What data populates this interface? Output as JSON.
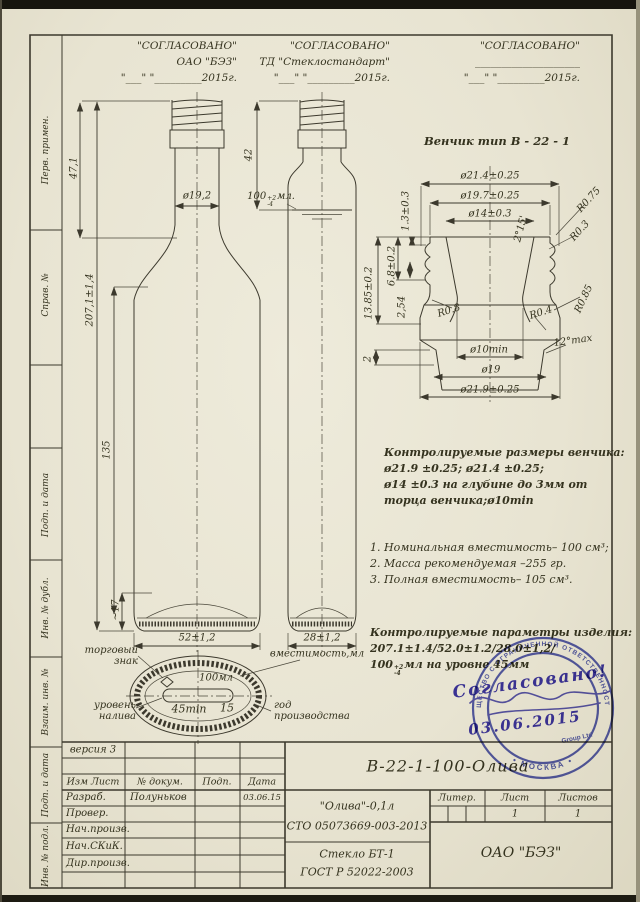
{
  "approvals": [
    {
      "title": "\"СОГЛАСОВАНО\"",
      "org": "ОАО  \"БЭЗ\"",
      "date": "\"___\" \"_________2015г."
    },
    {
      "title": "\"СОГЛАСОВАНО\"",
      "org": "ТД  \"Стеклостандарт\"",
      "date": "\"___\" \"_________2015г."
    },
    {
      "title": "\"СОГЛАСОВАНО\"",
      "org": "____________________",
      "date": "\"___\" \"_________2015г."
    }
  ],
  "margin": [
    "Перв. примен.",
    "Справ. №",
    "Подп. и дата",
    "Инв. № дубл.",
    "Взаим. инв. №",
    "Подп. и дата",
    "Инв. № подл."
  ],
  "bottle": {
    "neck_h": "47,1",
    "neck_d": "ø19,2",
    "total_h": "207,1±1,4",
    "body_h": "135",
    "base_h": "~17",
    "width_front": "52±1,2",
    "side_top": "42",
    "fill_base": "100",
    "fill_sup": "+2",
    "fill_sub": "-4",
    "fill_unit": "мл.",
    "width_side": "28±1,2",
    "capacity_label": "вместимость,мл"
  },
  "finish": {
    "title": "Венчик тип В - 22 - 1",
    "d1": "ø21.4±0.25",
    "d2": "ø19.7±0.25",
    "d3": "ø14±0.3",
    "t1": "1.3±0.3",
    "angle1": "2°15'",
    "r075": "R0.75",
    "r03": "R0.3",
    "h1": "13.85±0.2",
    "h2": "6.8±0.2",
    "h3": "2,54",
    "r08": "R0.8",
    "r04": "R0.4",
    "r085": "R0.85",
    "angle2": "12°max",
    "h4": "2",
    "d4": "ø10min",
    "d5": "ø19",
    "d6": "ø21.9±0.25"
  },
  "notes": {
    "finish_title": "Контролируемые размеры венчика:",
    "finish_l1": "ø21.9 ±0.25; ø21.4 ±0.25;",
    "finish_l2": "ø14 ±0.3 на глубине до 3мм от",
    "finish_l3": "торца венчика;ø10min",
    "list": [
      "1. Номинальная вместимость– 100 см³;",
      "2. Масса рекомендуемая –255 гр.",
      "3. Полная вместимость– 105 см³."
    ],
    "params_title": "Контролируемые параметры изделия:",
    "params_l1": "207.1±1.4/52.0±1.2/28.0±1,2/",
    "params_l2a": "100",
    "params_sup": "+2",
    "params_sub": "-4",
    "params_l2b": "мл на уровне 45мм"
  },
  "base_view": {
    "trademark": "торговый знак",
    "fill_level": "уровень налива",
    "year": "год производства",
    "vol": "100мл",
    "min45": "45min",
    "n15": "15"
  },
  "titleblock": {
    "version": "версия 3",
    "col_izm": "Изм Лист",
    "col_doc": "№ докум.",
    "col_sign": "Подп.",
    "col_date": "Дата",
    "row1_role": "Разраб.",
    "row1_name": "Полуньков",
    "row1_date": "03.06.15",
    "row2_role": "Провер.",
    "row3_role": "Нач.произв.",
    "row4_role": "Нач.СКиК.",
    "row5_role": "Дир.произв.",
    "designation": "В-22-1-100-Олива",
    "product1": "\"Олива\"-0,1л",
    "product2": "СТО 05073669-003-2013",
    "material1": "Стекло БТ-1",
    "material2": "ГОСТ Р 52022-2003",
    "liter_label": "Литер.",
    "sheet_label": "Лист",
    "sheets_label": "Листов",
    "sheet_val": "1",
    "sheets_val": "1",
    "company": "ОАО  \"БЭЗ\""
  },
  "stamp": {
    "ring_top": "ОБЩЕСТВО С ОГРАНИЧЕННОЙ ОТВЕТСТВЕННОСТЬЮ",
    "ring_bottom": "•  МОСКВА  •",
    "inner": "Group Ltd",
    "hand1": "Согласовано!",
    "date": "03.06.2015"
  }
}
